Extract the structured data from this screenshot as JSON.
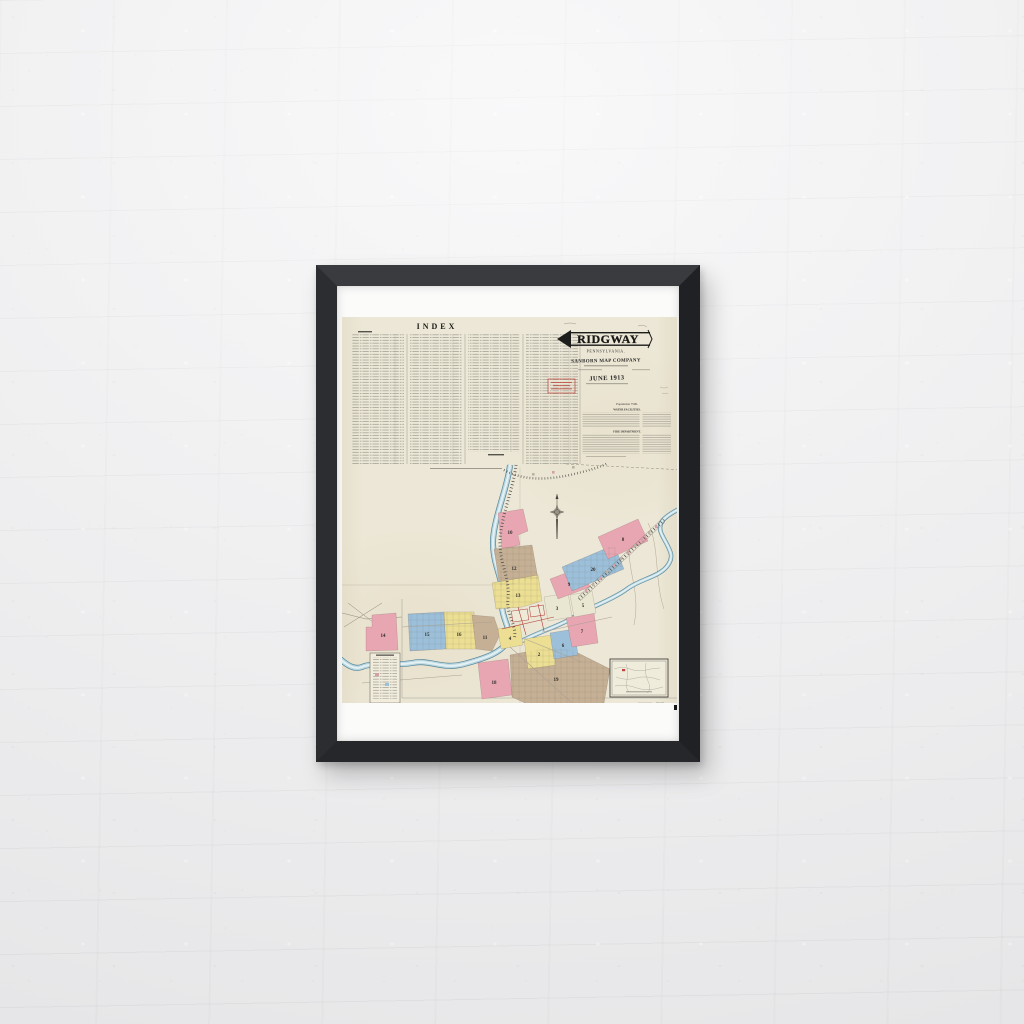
{
  "art": {
    "index": {
      "title": "INDEX"
    },
    "title_block": {
      "city": "RIDGWAY",
      "state": "PENNSYLVANIA.",
      "publisher": "SANBORN MAP COMPANY",
      "date": "JUNE 1913"
    },
    "notes": {
      "heading": "Population 7500.",
      "subheading_1": "WATER FACILITIES.",
      "subheading_2": "FIRE DEPARTMENT."
    },
    "map": {
      "districts": [
        {
          "label": "10",
          "color": "#e7a6b2"
        },
        {
          "label": "12",
          "color": "#c6b095"
        },
        {
          "label": "13",
          "color": "#ecdf94"
        },
        {
          "label": "14",
          "color": "#e7a6b2"
        },
        {
          "label": "15",
          "color": "#9cc0da"
        },
        {
          "label": "16",
          "color": "#ecdf94"
        },
        {
          "label": "11",
          "color": "#c6b095"
        },
        {
          "label": "18",
          "color": "#e7a6b2"
        },
        {
          "label": "19",
          "color": "#c6b095"
        },
        {
          "label": "2",
          "color": "#ecdf94"
        },
        {
          "label": "6",
          "color": "#9cc0da"
        },
        {
          "label": "7",
          "color": "#e7a6b2"
        },
        {
          "label": "4",
          "color": "#ecdf94"
        },
        {
          "label": "3",
          "color": "#e9e7d2"
        },
        {
          "label": "5",
          "color": "#e9e7d2"
        },
        {
          "label": "9",
          "color": "#e7a6b2"
        },
        {
          "label": "20",
          "color": "#9cc0da"
        },
        {
          "label": "8",
          "color": "#e7a6b2"
        }
      ],
      "palette": {
        "paper": "#ece7d6",
        "frame": "#26272a",
        "pink": "#e7a6b2",
        "blue": "#9cc0da",
        "yellow": "#ecdf94",
        "tan": "#c6b095",
        "river": "#9cc3d0",
        "rail": "#4a4a44",
        "accent_red": "#b8443c"
      }
    }
  }
}
